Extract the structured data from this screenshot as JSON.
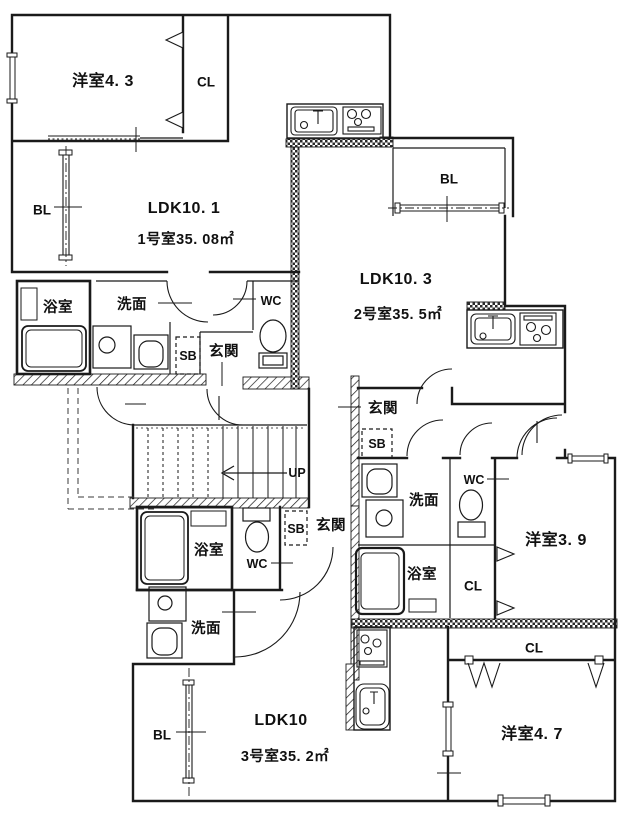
{
  "colors": {
    "line": "#1a1a1a",
    "background": "#ffffff"
  },
  "unit1": {
    "room": "洋室4. 3",
    "closet": "CL",
    "balcony": "BL",
    "ldk": "LDK10. 1",
    "area": "1号室35. 08㎡",
    "bath": "浴室",
    "wash": "洗面",
    "wc": "WC",
    "shoebox": "SB",
    "entrance": "玄関"
  },
  "unit2": {
    "balcony": "BL",
    "ldk": "LDK10. 3",
    "area": "2号室35. 5㎡",
    "entrance": "玄関",
    "shoebox": "SB",
    "wash": "洗面",
    "wc": "WC",
    "room": "洋室3. 9",
    "bath": "浴室",
    "closet": "CL"
  },
  "unit3": {
    "entrance": "玄関",
    "shoebox": "SB",
    "wc": "WC",
    "bath": "浴室",
    "wash": "洗面",
    "balcony": "BL",
    "ldk": "LDK10",
    "area": "3号室35. 2㎡",
    "closet": "CL",
    "room": "洋室4. 7"
  },
  "stairs": {
    "up": "UP"
  }
}
